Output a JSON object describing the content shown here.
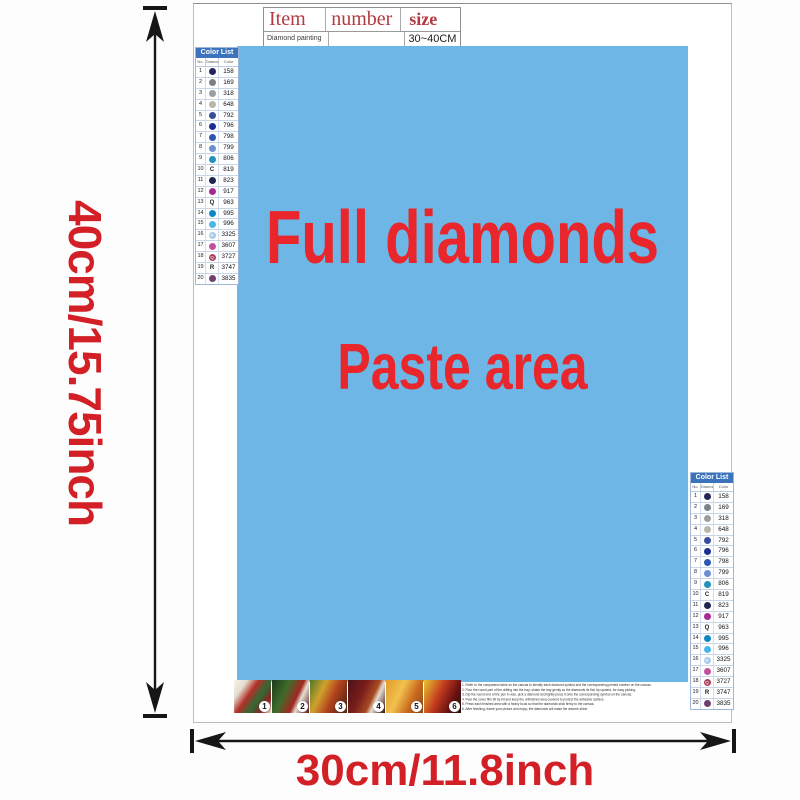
{
  "item_table": {
    "headers": [
      "Item",
      "number",
      "size"
    ],
    "row": [
      "Diamond painting",
      "",
      "30~40CM"
    ]
  },
  "paste_area": {
    "line1": "Full diamonds",
    "line2": "Paste area",
    "background_color": "#6db6e5",
    "text_color": "#e8262b"
  },
  "dimensions": {
    "height_label": "40cm/15.75inch",
    "width_label": "30cm/11.8inch",
    "label_color": "#d22026"
  },
  "color_list": {
    "title": "Color List",
    "columns": [
      "No.",
      "Diamond",
      "Color"
    ],
    "rows": [
      {
        "no": "1",
        "code": "158",
        "symbol": "",
        "dot": "#23265c"
      },
      {
        "no": "2",
        "code": "169",
        "symbol": "",
        "dot": "#7b8184"
      },
      {
        "no": "3",
        "code": "318",
        "symbol": "",
        "dot": "#9a9da1"
      },
      {
        "no": "4",
        "code": "648",
        "symbol": "",
        "dot": "#b8b5a9"
      },
      {
        "no": "5",
        "code": "792",
        "symbol": "",
        "dot": "#3a4d9a"
      },
      {
        "no": "6",
        "code": "796",
        "symbol": "",
        "dot": "#1d2f96"
      },
      {
        "no": "7",
        "code": "798",
        "symbol": "",
        "dot": "#2b57b0"
      },
      {
        "no": "8",
        "code": "799",
        "symbol": "",
        "dot": "#6c8ed3"
      },
      {
        "no": "9",
        "code": "806",
        "symbol": "",
        "dot": "#1d93bd"
      },
      {
        "no": "10",
        "code": "819",
        "symbol": "C",
        "dot": ""
      },
      {
        "no": "11",
        "code": "823",
        "symbol": "",
        "dot": "#1b2550"
      },
      {
        "no": "12",
        "code": "917",
        "symbol": "",
        "dot": "#a82a94"
      },
      {
        "no": "13",
        "code": "963",
        "symbol": "Q",
        "dot": ""
      },
      {
        "no": "14",
        "code": "995",
        "symbol": "",
        "dot": "#0e87c6"
      },
      {
        "no": "15",
        "code": "996",
        "symbol": "",
        "dot": "#4ab5e8"
      },
      {
        "no": "16",
        "code": "3325",
        "symbol": "R",
        "dot": "#a8c8e8"
      },
      {
        "no": "17",
        "code": "3607",
        "symbol": "",
        "dot": "#c44f9e"
      },
      {
        "no": "18",
        "code": "3727",
        "symbol": "Q",
        "dot": "#a8425f"
      },
      {
        "no": "19",
        "code": "3747",
        "symbol": "R",
        "dot": ""
      },
      {
        "no": "20",
        "code": "3835",
        "symbol": "",
        "dot": "#6e3f6e"
      }
    ]
  },
  "bottom_strip": {
    "steps": [
      "1",
      "2",
      "3",
      "4",
      "5",
      "6"
    ]
  },
  "instructions_lines": [
    "1. Refer to the comparison table on the canvas to identify each diamond symbol and the corresponding printed number on the canvas.",
    "2. Pour the round part of the drilling into the tray; shake the tray gently so the diamonds lie flat, tip upward, for easy picking.",
    "3. Dip the round end of the pen in wax, pick a diamond and lightly press it onto the corresponding symbol on the canvas.",
    "4. Peel the cover film bit by bit and keep the unfinished area covered to protect the adhesive surface.",
    "5. Press each finished area with a heavy book so that the diamonds stick firmly to the canvas.",
    "6. After finishing, frame your picture and enjoy; the diamonds will make the artwork shine."
  ]
}
